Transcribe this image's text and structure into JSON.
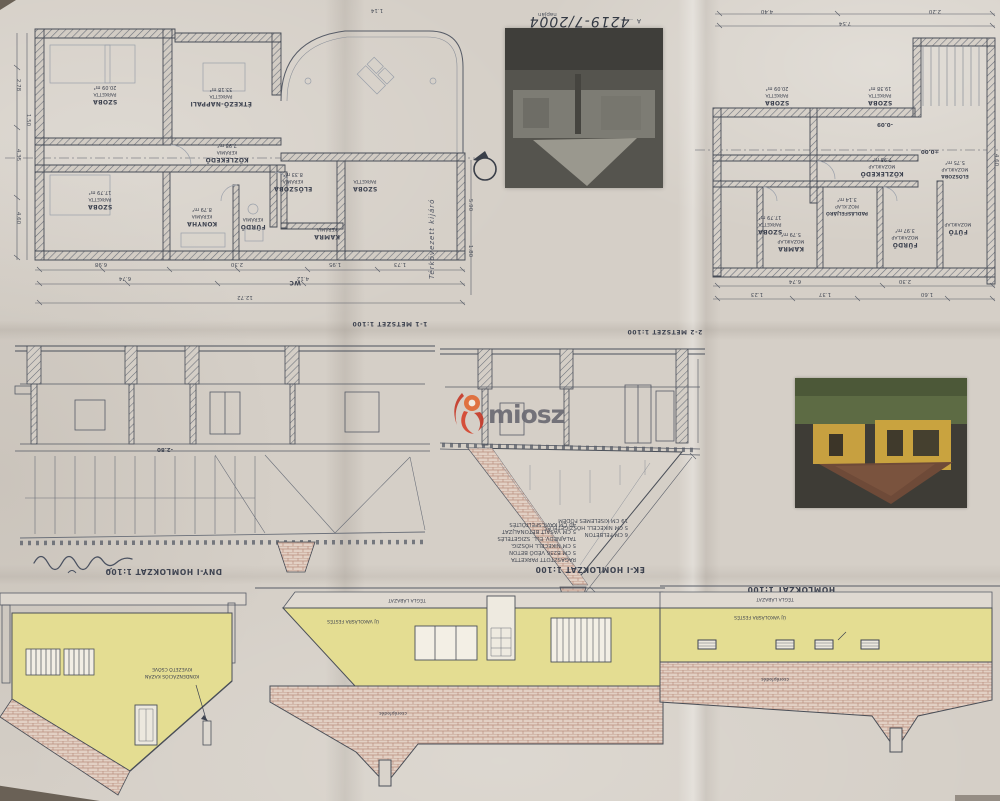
{
  "stamp": {
    "approval": "Jóváhagyta a Mohács Város Polgármesteri",
    "hivatala": "Hivatala",
    "date": "2004 ÁPR 20.",
    "file_number": "4219-7/2004",
    "napjan": "napján",
    "a_mark": "A ………"
  },
  "watermark": {
    "text": "miosz",
    "logo_color": "#d5452f",
    "text_color": "#6b6b73"
  },
  "titles": {
    "metszet1": "1-1 METSZET 1:100",
    "metszet2": "2-2 METSZET 1:100",
    "dny": "DNY-I HOMLOKZAT 1:100",
    "ek": "ÉK-I HOMLOKZAT 1:100",
    "dk": "HOMLOKZAT 1:100"
  },
  "plan_left": {
    "rooms": {
      "szoba1": {
        "name": "SZOBA",
        "finish": "PARKETTA",
        "area": "20.09 m²"
      },
      "etkezo": {
        "name": "ÉTKEZŐ-NAPPALI",
        "finish": "PARKETTA",
        "area": "33.18 m²"
      },
      "szoba2": {
        "name": "SZOBA",
        "finish": "PARKETTA",
        "area": "17.79 m²"
      },
      "konyha": {
        "name": "KONYHA",
        "finish": "KERÁMIA",
        "area": "8.79 m²"
      },
      "furdo": {
        "name": "FÜRDŐ",
        "finish": "KERÁMIA"
      },
      "kozlekedo": {
        "name": "KÖZLEKEDŐ",
        "finish": "KERÁMIA",
        "area": "7.98 m²"
      },
      "eloszoba": {
        "name": "ELŐSZOBA",
        "finish": "KERÁMIA",
        "area": "8.33 m²"
      },
      "szoba3": {
        "name": "SZOBA",
        "finish": "PARKETTA"
      },
      "kamra": {
        "name": "KAMRA",
        "finish": "KERÁMIA"
      },
      "wc": {
        "name": "WC"
      }
    },
    "dims": {
      "d1": "6.98",
      "d2": "2.30",
      "d3": "6.74",
      "d4": "1.95",
      "d5": "1.73",
      "d6": "12.72",
      "d7": "2.78",
      "d8": "4.35",
      "d9": "4.60",
      "d10": "1.50",
      "d11": "4.12",
      "d12": "1.14",
      "d13": "5.90",
      "d14": "1.80"
    }
  },
  "plan_right": {
    "rooms": {
      "szoba_tl": {
        "name": "SZOBA",
        "finish": "PARKETTA",
        "area": "20.09 m²"
      },
      "szoba_tr": {
        "name": "SZOBA",
        "finish": "PARKETTA",
        "area": "19.38 m²"
      },
      "szoba_bl": {
        "name": "SZOBA",
        "finish": "PARKETTA",
        "area": "17.79 m²"
      },
      "kozlekedo": {
        "name": "KÖZLEKEDŐ",
        "finish": "MOZAIKLAP",
        "area": "7.98 m²"
      },
      "padlas": {
        "name": "PADLÁSFELJÁRÓ",
        "finish": "MOZ.KLAP",
        "area": "3.14 m²"
      },
      "kamra": {
        "name": "KAMRA",
        "finish": "MOZAIKLAP",
        "area": "5.79 m²"
      },
      "furdo": {
        "name": "FÜRDŐ",
        "finish": "MOZAIKLAP",
        "area": "3.97 m²"
      },
      "eloszoba": {
        "name": "ELŐSZOBA",
        "finish": "MOZAIKLAP",
        "area": "5.75 m²"
      },
      "futo": {
        "name": "FŰTŐ",
        "finish": "MOZAIKLAP"
      }
    },
    "levels": {
      "l1": "-0.09",
      "l2": "±0.00"
    },
    "dims": {
      "d1": "4.40",
      "d2": "7.54",
      "d3": "2.20",
      "d4": "4.60",
      "d5": "6.74",
      "d6": "2.30",
      "d7": "1.23",
      "d8": "1.37",
      "d9": "1.60"
    }
  },
  "sections": {
    "s1_level": "-2.80",
    "s1_notes": {
      "n1": "6 CM FELBETON",
      "n2": "5 CM NIKECELL HŐSZIGETELÉS",
      "n3": "19 CM KISELEMES FÖDÉM"
    },
    "s2_notes": {
      "n1": "RAGASZTOTT PARKETTA",
      "n2": "5 CM B236 VÉDŐ BETON",
      "n3": "5 CM NIKECELL HŐSZIG.",
      "n4": "TALAJNEDV. ELL. SZIGETELÉS",
      "n5": "5 CM VASALT BETONALJZAT",
      "n6": "40 CM KAVICSFELTÖLTÉS"
    }
  },
  "elevations": {
    "dny_annotation1": "KONDENZÁCIÓS KAZÁN",
    "dny_annotation2": "KIVEZETŐ CSŐVE",
    "roof_label": "cserépfedés",
    "wall_label": "ÚJ VAKOLÁSRA FESTÉS",
    "plinth_label": "TÉGLA LÁBAZAT"
  },
  "handwriting": {
    "terkovezett": "Térkövezett kijáró"
  },
  "colors": {
    "paper": "#d5cfc7",
    "ink": "#4b515c",
    "facade_yellow": "#e5de92",
    "brick": "#b98e7d",
    "brick_bg": "#e2d0c4",
    "watermark_red": "#d5452f"
  }
}
